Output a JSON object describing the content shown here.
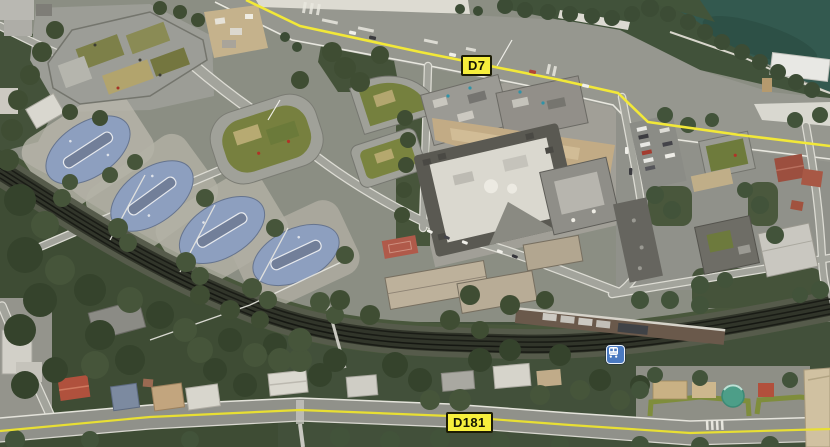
{
  "map": {
    "type": "satellite-imagery-view",
    "route_badges": [
      {
        "id": "d7",
        "label": "D7"
      },
      {
        "id": "d181",
        "label": "D181"
      }
    ],
    "icons": [
      {
        "name": "train-station-icon",
        "meaning": "railway station marker"
      }
    ],
    "colors": {
      "route_badge_bg": "#f7ef3c",
      "route_badge_border": "#1c1c04",
      "route_line_yellow": "#f2e838",
      "river_water": "#33594f",
      "forest_green": "#3e4c34",
      "road_gray": "#96978f",
      "railway_dark": "#31352a",
      "oval_roof_blue": "#8d9fbf",
      "station_icon_blue": "#4a7ac1"
    }
  }
}
